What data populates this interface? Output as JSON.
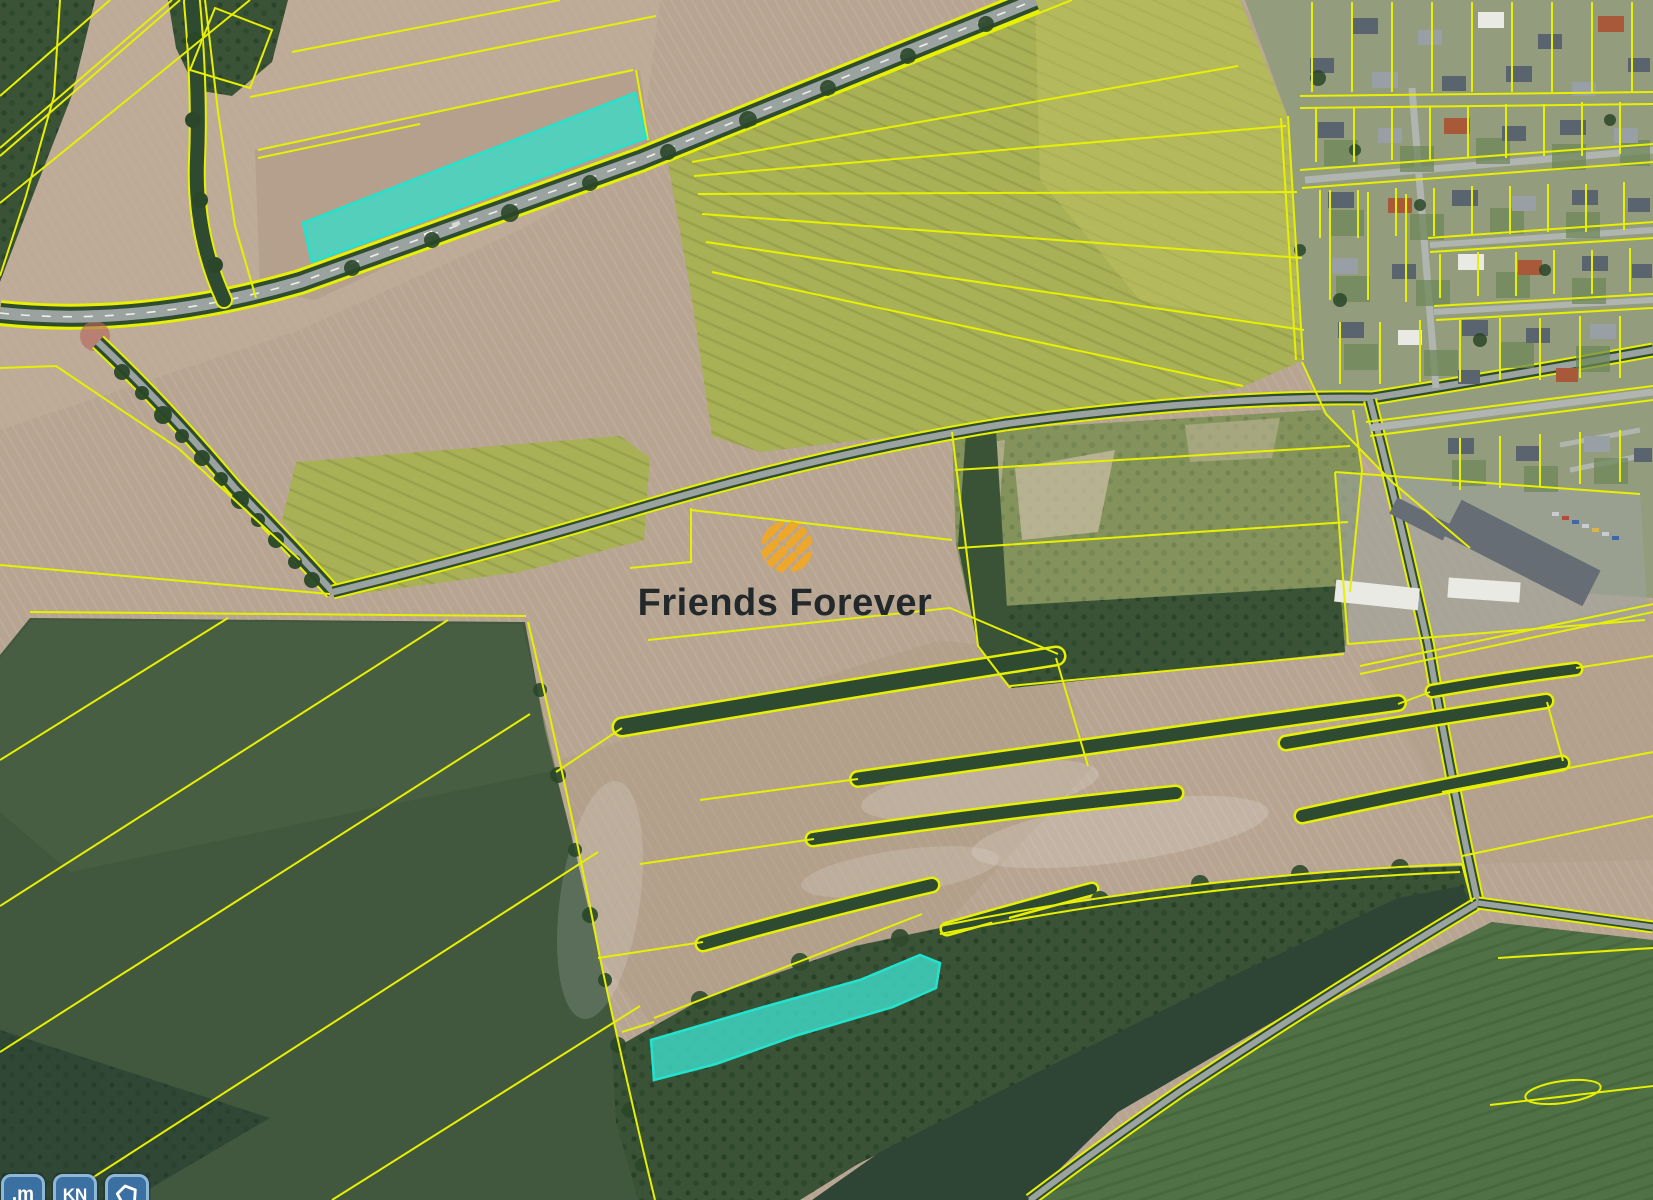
{
  "watermark": {
    "brand": "Friends Forever",
    "icon": "hatch-stripes-icon"
  },
  "toolbar": {
    "buttons": [
      {
        "id": "unit-meters",
        "label": ".m"
      },
      {
        "id": "cadastre-kn",
        "label": "KN"
      },
      {
        "id": "parcel-shape",
        "label": "",
        "icon": "pentagon-parcel-icon"
      }
    ]
  },
  "map": {
    "type": "aerial-cadastral-map",
    "highlighted_parcels": [
      {
        "id": "parcel-north-roadside"
      },
      {
        "id": "parcel-south-woodland"
      }
    ]
  },
  "colors": {
    "cad": "#E7F000",
    "cyan": "#3ED9C7",
    "cyanEdge": "#22E3CE",
    "road": "#9BA3A0",
    "roadEdge": "#2F4C31",
    "logoOrange": "#EDA72B",
    "textDark": "#23282B",
    "btnBg": "#3B70A2",
    "btnBorder": "#8FB7D6",
    "btnText": "#FFFFFF",
    "baseTan": "#B7A592",
    "rapeseed": "#A9B156",
    "rapeBright": "#BDC163",
    "darkField": "#41573E",
    "darkField2": "#2E4434",
    "forest": "#3A5337",
    "scrub": "#84935C",
    "villageBase": "#939C7C",
    "grass": "#507046"
  }
}
